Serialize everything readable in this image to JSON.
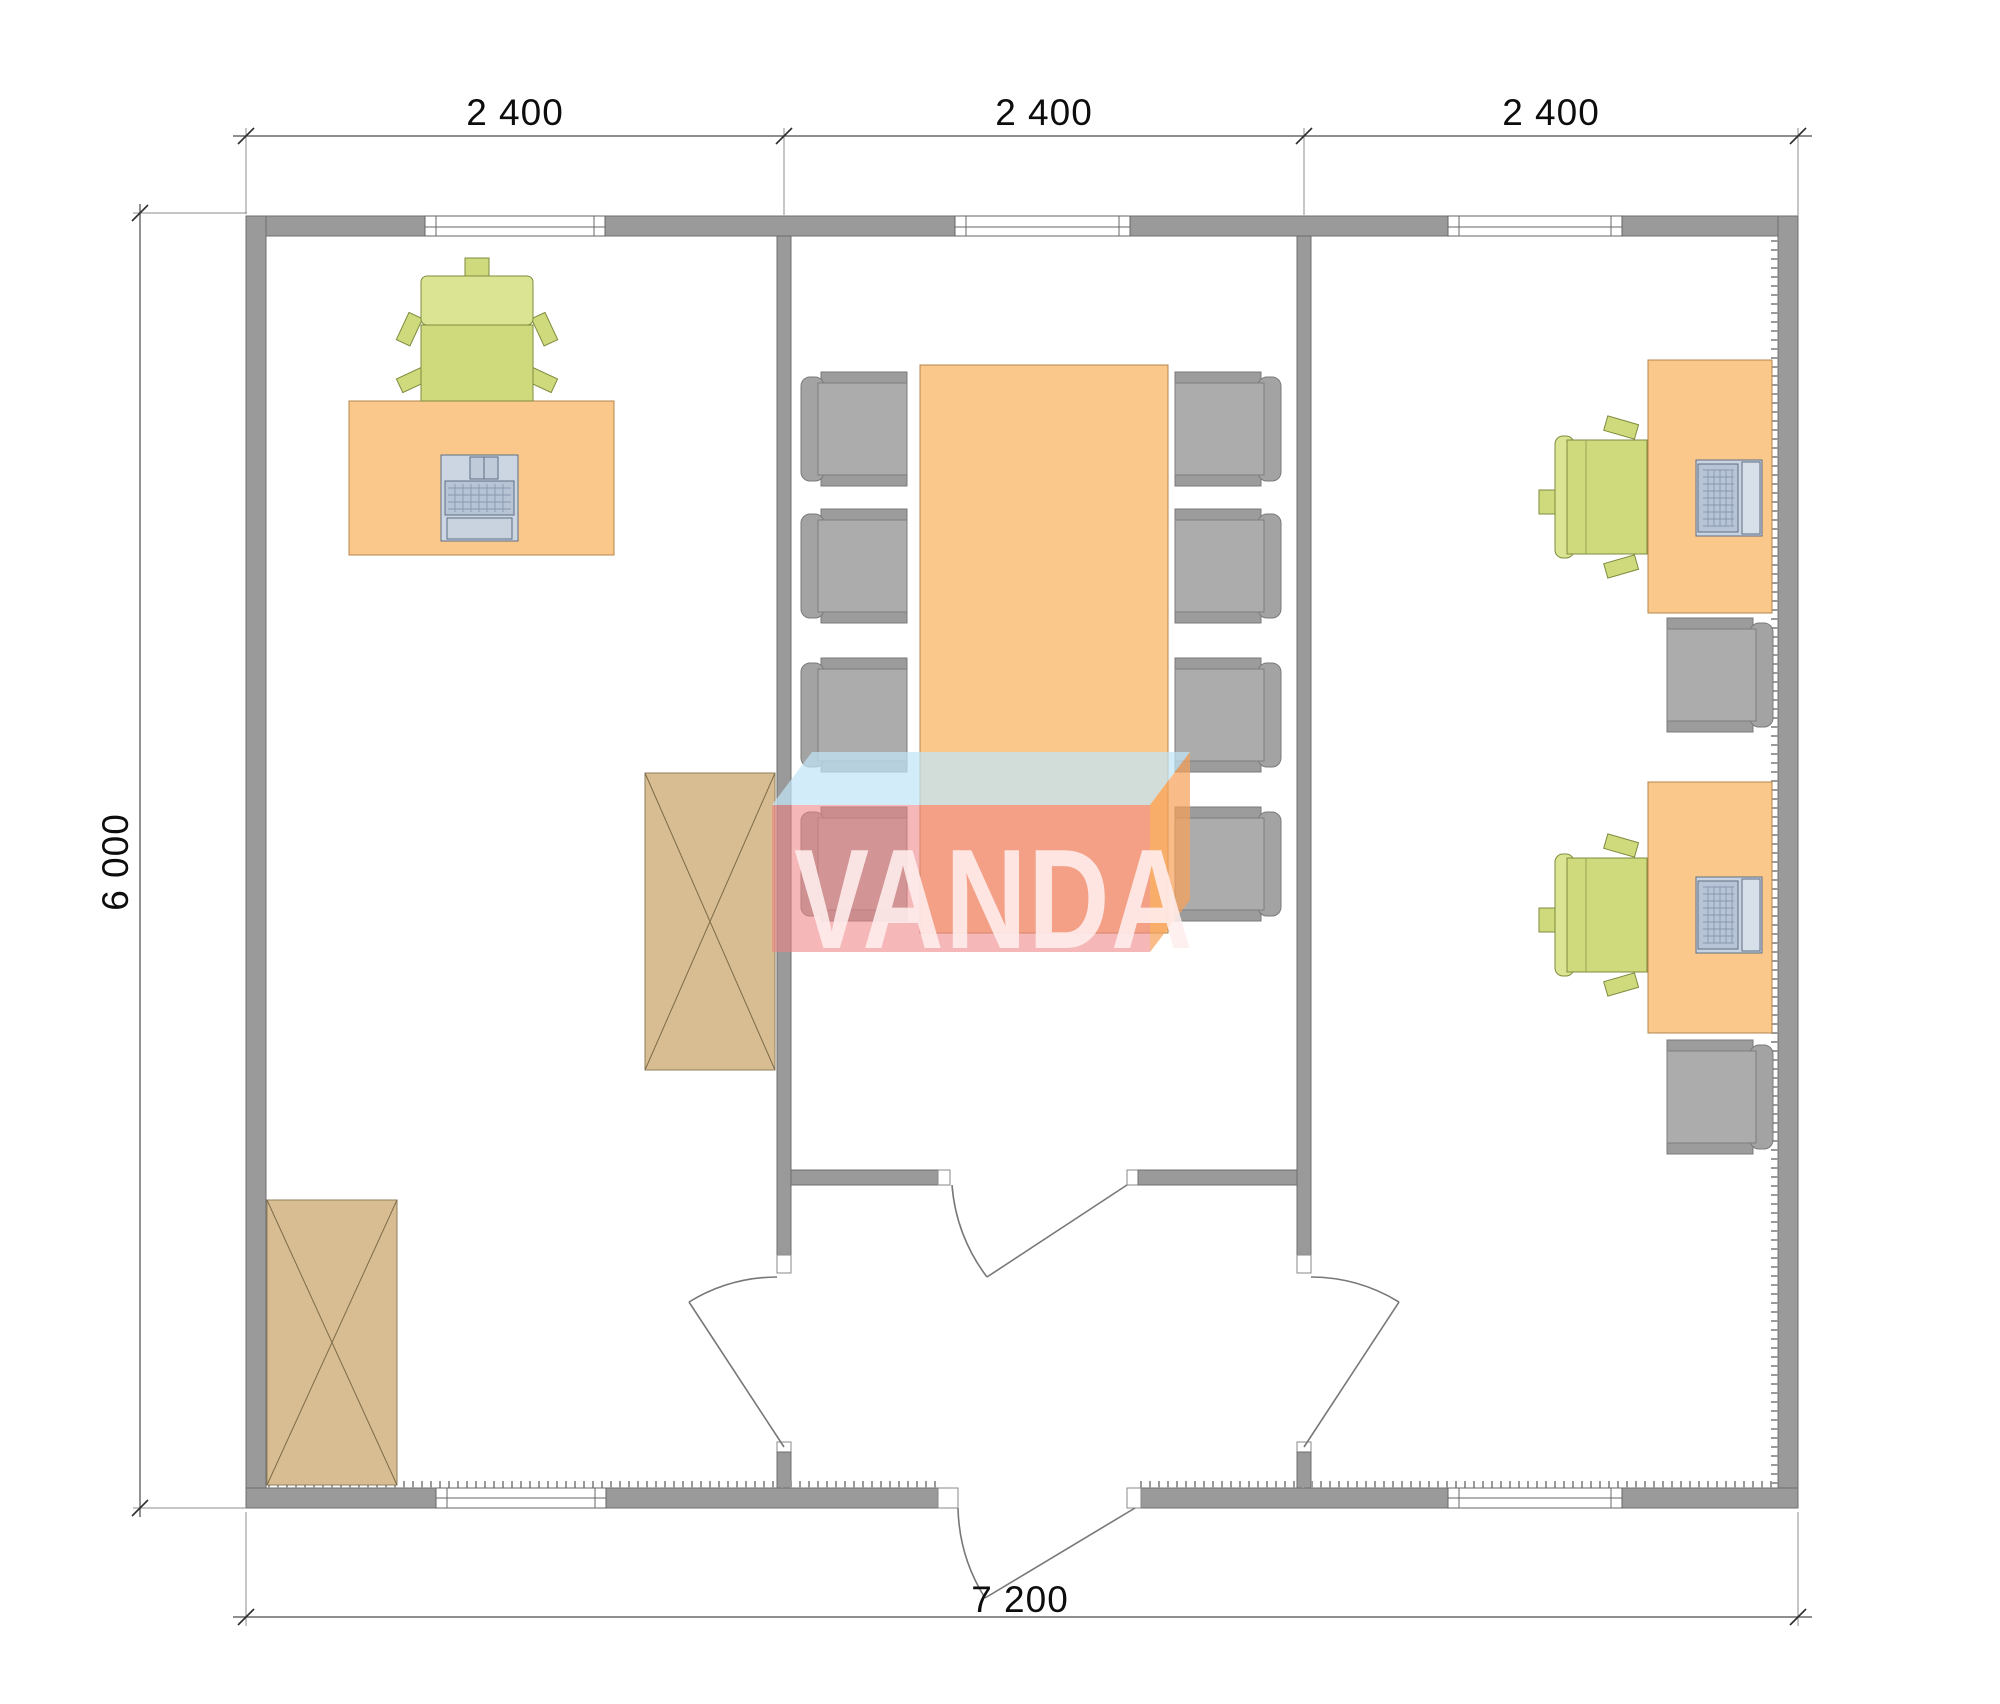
{
  "watermark": {
    "text": "VANDA",
    "front_color": "#ee8383",
    "top_color": "#c2e4f6",
    "side_color": "#f6a25c"
  },
  "dimensions": {
    "top_segments": [
      {
        "label": "2 400"
      },
      {
        "label": "2 400"
      },
      {
        "label": "2 400"
      }
    ],
    "left": {
      "label": "6 000"
    },
    "bottom": {
      "label": "7 200"
    }
  },
  "plan": {
    "type": "office-floor-plan",
    "rooms": [
      "office-left",
      "meeting-room",
      "office-right",
      "entrance-vestibule"
    ],
    "furniture_counts": {
      "desks": 3,
      "desk-chairs-green": 3,
      "conference-table": 1,
      "conference-chairs": 8,
      "spare-chairs-gray": 2,
      "wardrobe-cabinets": 2,
      "computers": 3
    },
    "colors": {
      "wall": "#9a9a9a",
      "wall_outline": "#6f6f6f",
      "desk_orange": "#fbc88b",
      "chair_green": "#cfda7d",
      "chair_gray": "#a9a9a9",
      "cabinet_tan": "#d8bc92",
      "laptop_blue": "#c9d4e2"
    }
  }
}
